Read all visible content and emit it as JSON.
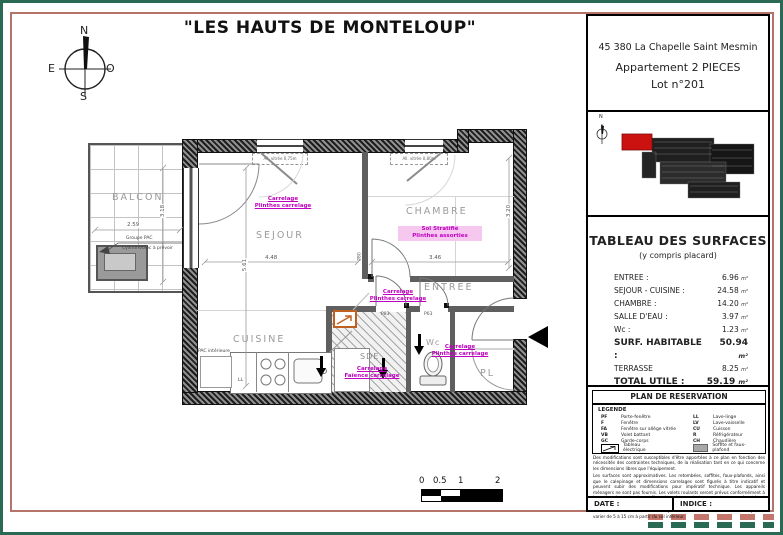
{
  "page": {
    "title": "\"LES HAUTS DE MONTELOUP\""
  },
  "title_block": {
    "address": "45 380 La Chapelle Saint Mesmin",
    "apartment_type": "Appartement 2 PIECES",
    "lot": "Lot n°201"
  },
  "compass": {
    "north": "N",
    "south": "S",
    "east": "E",
    "west": "O"
  },
  "key_plan": {
    "north": "N"
  },
  "surfaces": {
    "title": "TABLEAU DES SURFACES",
    "subtitle": "(y compris placard)",
    "unit": "m²",
    "rows": [
      {
        "label": "ENTREE :",
        "value": "6.96"
      },
      {
        "label": "SEJOUR - CUISINE :",
        "value": "24.58"
      },
      {
        "label": "CHAMBRE :",
        "value": "14.20"
      },
      {
        "label": "SALLE D'EAU :",
        "value": "3.97"
      },
      {
        "label": "Wc :",
        "value": "1.23"
      },
      {
        "label": "SURF. HABITABLE :",
        "value": "50.94"
      },
      {
        "label": "TERRASSE",
        "value": "8.25"
      },
      {
        "label": "TOTAL UTILE :",
        "value": "59.19"
      }
    ]
  },
  "reservation": {
    "header": "PLAN DE RESERVATION",
    "legend_title": "LEGENDE",
    "legend_left": [
      {
        "abbr": "PF",
        "label": "Porte-fenêtre"
      },
      {
        "abbr": "F",
        "label": "Fenêtre"
      },
      {
        "abbr": "FA",
        "label": "Fenêtre sur allège vitrée"
      },
      {
        "abbr": "VB",
        "label": "Volet battant"
      },
      {
        "abbr": "GC",
        "label": "Garde-corps"
      }
    ],
    "legend_right": [
      {
        "abbr": "LL",
        "label": "Lave-linge"
      },
      {
        "abbr": "LV",
        "label": "Lave-vaisselle"
      },
      {
        "abbr": "CU",
        "label": "Cuisson"
      },
      {
        "abbr": "R",
        "label": "Réfrigérateur"
      },
      {
        "abbr": "CH",
        "label": "Chaudière"
      }
    ],
    "legend_electric": "Tableau électrique",
    "legend_soffit": "Soffite et faux-plafond",
    "disclaimer": [
      "Des modifications sont susceptibles d'être apportées à ce plan en fonction des nécessités des contraintes techniques, de la réalisation tant en ce qui concerne les dimensions libres que l'équipement.",
      "Les surfaces sont approximatives. Les retombées, soffites, faux-plafonds, ainsi que le calepinage et dimensions carrelages sont figurés à titre indicatif et peuvent subir des modifications pour impératif technique. Les appareils ménagers ne sont pas fournis. Les volets roulants seront prévus conformément à la notice de vente. Les coffres de volets roulants ne sont pas représentés et seront abaissés à l'intérieur.",
      "La hauteur des seuils au droit des portes-fenêtres sur balcon ou terrasse pourra varier de 5 à 15 cm à partir du sol intérieur."
    ],
    "date_label": "DATE :",
    "indice_label": "INDICE :"
  },
  "plan": {
    "rooms": {
      "balcon": "BALCON",
      "sejour": "SEJOUR",
      "chambre": "CHAMBRE",
      "cuisine": "CUISINE",
      "entree": "ENTREE",
      "sde": "SDE",
      "wc": "Wc",
      "pl": "PL"
    },
    "finishes": {
      "sejour": [
        "Carrelage",
        "Plinthes carrelage"
      ],
      "chambre": [
        "Sol Stratifié",
        "Plinthes assorties"
      ],
      "sde_door": [
        "Carrelage",
        "Plinthes carrelage"
      ],
      "sde": [
        "Carrelage",
        "Faïence carrelage"
      ],
      "entree": [
        "Carrelage",
        "Plinthes carrelage"
      ]
    },
    "dimensions": {
      "sejour_w": "4.48",
      "sejour_h": "5.61",
      "chambre_w": "3.46",
      "chambre_h": "3.20",
      "balcon_w": "2.59",
      "balcon_h": "3.18"
    },
    "doors": {
      "chambre": "P80",
      "sde": "P83",
      "wc": "P63"
    },
    "labels": {
      "pac_group": "Groupe PAC",
      "pac_note": "Cylindre/bloc à prévoir",
      "pac_int": "PAC intérieure",
      "ll": "LL",
      "window_sejour": "All. vitrée 0,75m",
      "window_chambre": "All. vitrée 0,80m"
    }
  },
  "scale_bar": {
    "labels": [
      "0",
      "0.5",
      "1",
      "2"
    ]
  },
  "colors": {
    "accent_magenta": "#c000c0",
    "border_green": "#2a6a54",
    "border_salmon": "#b5736a",
    "key_plan_highlight": "#cc1111"
  }
}
